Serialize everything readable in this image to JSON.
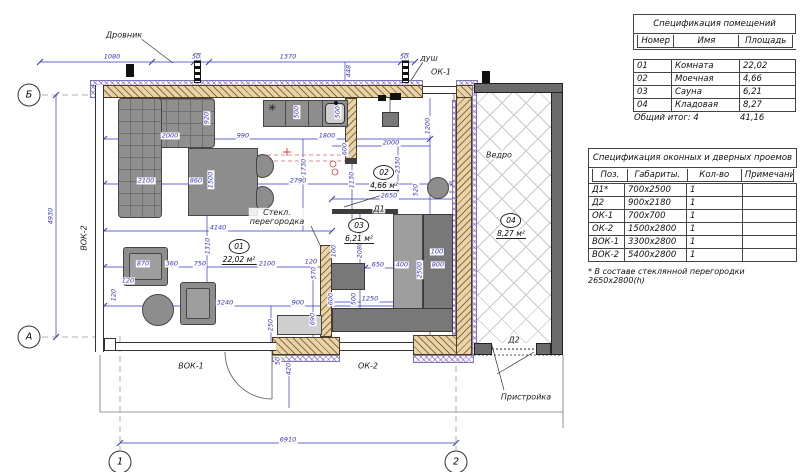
{
  "spec_rooms": {
    "title": "Спецификация помещений",
    "headers": [
      "Номер",
      "Имя",
      "Площадь"
    ],
    "rows": [
      [
        "01",
        "Комната",
        "22,02"
      ],
      [
        "02",
        "Моечная",
        "4,66"
      ],
      [
        "03",
        "Сауна",
        "6,21"
      ],
      [
        "04",
        "Кладовая",
        "8,27"
      ]
    ],
    "total_label": "Общий итог: 4",
    "total_value": "41,16"
  },
  "spec_openings": {
    "title": "Спецификация оконных и дверных проемов",
    "headers": [
      "Поз.",
      "Габариты.",
      "Кол-во",
      "Примечание"
    ],
    "rows": [
      [
        "Д1*",
        "700x2500",
        "1",
        ""
      ],
      [
        "Д2",
        "900x2180",
        "1",
        ""
      ],
      [
        "ОК-1",
        "700x700",
        "1",
        ""
      ],
      [
        "ОК-2",
        "1500x2800",
        "1",
        ""
      ],
      [
        "ВОК-1",
        "3300x2800",
        "1",
        ""
      ],
      [
        "ВОК-2",
        "5400x2800",
        "1",
        ""
      ]
    ],
    "footnote": "* В составе стеклянной перегородки 2650x2800(h)"
  },
  "plan": {
    "axis_bubbles": [
      {
        "label": "Б",
        "x": 29,
        "y": 95
      },
      {
        "label": "А",
        "x": 29,
        "y": 337
      },
      {
        "label": "1",
        "x": 120,
        "y": 462
      },
      {
        "label": "2",
        "x": 456,
        "y": 462
      }
    ],
    "room_tags": [
      {
        "num": "01",
        "area": "22,02 м²",
        "x": 239,
        "y": 252
      },
      {
        "num": "02",
        "area": "4,66 м²",
        "x": 384,
        "y": 178
      },
      {
        "num": "03",
        "area": "6,21 м²",
        "x": 359,
        "y": 231
      },
      {
        "num": "04",
        "area": "8,27 м²",
        "x": 511,
        "y": 226
      }
    ],
    "labels": [
      {
        "id": "drovnik",
        "text": "Дровник",
        "x": 124,
        "y": 35
      },
      {
        "id": "dush",
        "text": "душ",
        "x": 429,
        "y": 58
      },
      {
        "id": "ok1",
        "text": "ОК-1",
        "x": 441,
        "y": 72
      },
      {
        "id": "vedro",
        "text": "Ведро",
        "x": 499,
        "y": 155
      },
      {
        "id": "steklo",
        "text": "Стекл.\nперегородка",
        "x": 277,
        "y": 217
      },
      {
        "id": "d1",
        "text": "Д1",
        "x": 379,
        "y": 209
      },
      {
        "id": "d2",
        "text": "Д2",
        "x": 514,
        "y": 340
      },
      {
        "id": "ok2",
        "text": "ОК-2",
        "x": 368,
        "y": 366
      },
      {
        "id": "vok1",
        "text": "ВОК-1",
        "x": 191,
        "y": 366
      },
      {
        "id": "vok2",
        "text": "ВОК-2",
        "x": 84,
        "y": 238,
        "rot": -90
      },
      {
        "id": "pristroyka",
        "text": "Пристройка",
        "x": 526,
        "y": 397
      }
    ],
    "dims": [
      {
        "t": "1080",
        "x": 112,
        "y": 57
      },
      {
        "t": "50",
        "x": 196,
        "y": 57
      },
      {
        "t": "1370",
        "x": 288,
        "y": 57
      },
      {
        "t": "50",
        "x": 404,
        "y": 57
      },
      {
        "t": "448",
        "x": 349,
        "y": 71,
        "v": 1
      },
      {
        "t": "4930",
        "x": 51,
        "y": 216,
        "v": 1
      },
      {
        "t": "6910",
        "x": 288,
        "y": 440
      },
      {
        "t": "2000",
        "x": 170,
        "y": 136
      },
      {
        "t": "920",
        "x": 207,
        "y": 118,
        "v": 1
      },
      {
        "t": "990",
        "x": 243,
        "y": 136
      },
      {
        "t": "1800",
        "x": 327,
        "y": 136
      },
      {
        "t": "600",
        "x": 345,
        "y": 149,
        "v": 1
      },
      {
        "t": "500",
        "x": 297,
        "y": 112,
        "v": 1
      },
      {
        "t": "500",
        "x": 338,
        "y": 112,
        "v": 1
      },
      {
        "t": "2100",
        "x": 146,
        "y": 181
      },
      {
        "t": "860",
        "x": 196,
        "y": 181
      },
      {
        "t": "1500",
        "x": 211,
        "y": 180,
        "v": 1
      },
      {
        "t": "2790",
        "x": 298,
        "y": 181
      },
      {
        "t": "1730",
        "x": 304,
        "y": 167,
        "v": 1
      },
      {
        "t": "1130",
        "x": 352,
        "y": 180,
        "v": 1
      },
      {
        "t": "1200",
        "x": 428,
        "y": 126,
        "v": 1
      },
      {
        "t": "2000",
        "x": 391,
        "y": 143
      },
      {
        "t": "2330",
        "x": 398,
        "y": 165,
        "v": 1
      },
      {
        "t": "2650",
        "x": 389,
        "y": 196
      },
      {
        "t": "520",
        "x": 416,
        "y": 190,
        "v": 1
      },
      {
        "t": "4140",
        "x": 218,
        "y": 228
      },
      {
        "t": "1310",
        "x": 208,
        "y": 246,
        "v": 1
      },
      {
        "t": "870",
        "x": 143,
        "y": 264
      },
      {
        "t": "360",
        "x": 172,
        "y": 264
      },
      {
        "t": "750",
        "x": 200,
        "y": 264
      },
      {
        "t": "2100",
        "x": 267,
        "y": 264
      },
      {
        "t": "3240",
        "x": 225,
        "y": 303
      },
      {
        "t": "120",
        "x": 114,
        "y": 295,
        "v": 1
      },
      {
        "t": "120",
        "x": 128,
        "y": 281
      },
      {
        "t": "2080",
        "x": 360,
        "y": 250,
        "v": 1
      },
      {
        "t": "100",
        "x": 437,
        "y": 252
      },
      {
        "t": "650",
        "x": 378,
        "y": 265
      },
      {
        "t": "400",
        "x": 402,
        "y": 265
      },
      {
        "t": "2500",
        "x": 420,
        "y": 270,
        "v": 1
      },
      {
        "t": "800",
        "x": 438,
        "y": 265
      },
      {
        "t": "570",
        "x": 314,
        "y": 273,
        "v": 1
      },
      {
        "t": "120",
        "x": 311,
        "y": 262
      },
      {
        "t": "100",
        "x": 334,
        "y": 251,
        "v": 1
      },
      {
        "t": "600",
        "x": 331,
        "y": 299,
        "v": 1
      },
      {
        "t": "900",
        "x": 298,
        "y": 303
      },
      {
        "t": "500",
        "x": 354,
        "y": 299,
        "v": 1
      },
      {
        "t": "1250",
        "x": 370,
        "y": 299
      },
      {
        "t": "690",
        "x": 313,
        "y": 319,
        "v": 1
      },
      {
        "t": "250",
        "x": 271,
        "y": 325,
        "v": 1
      },
      {
        "t": "420",
        "x": 289,
        "y": 369,
        "v": 1
      },
      {
        "t": "50",
        "x": 278,
        "y": 361,
        "v": 1
      }
    ]
  },
  "colors": {
    "dim_blue": "#3535c5",
    "red_line": "#cc4040",
    "wall_tan": "#e9d3a9",
    "annex_gray": "#6b6b6b"
  }
}
